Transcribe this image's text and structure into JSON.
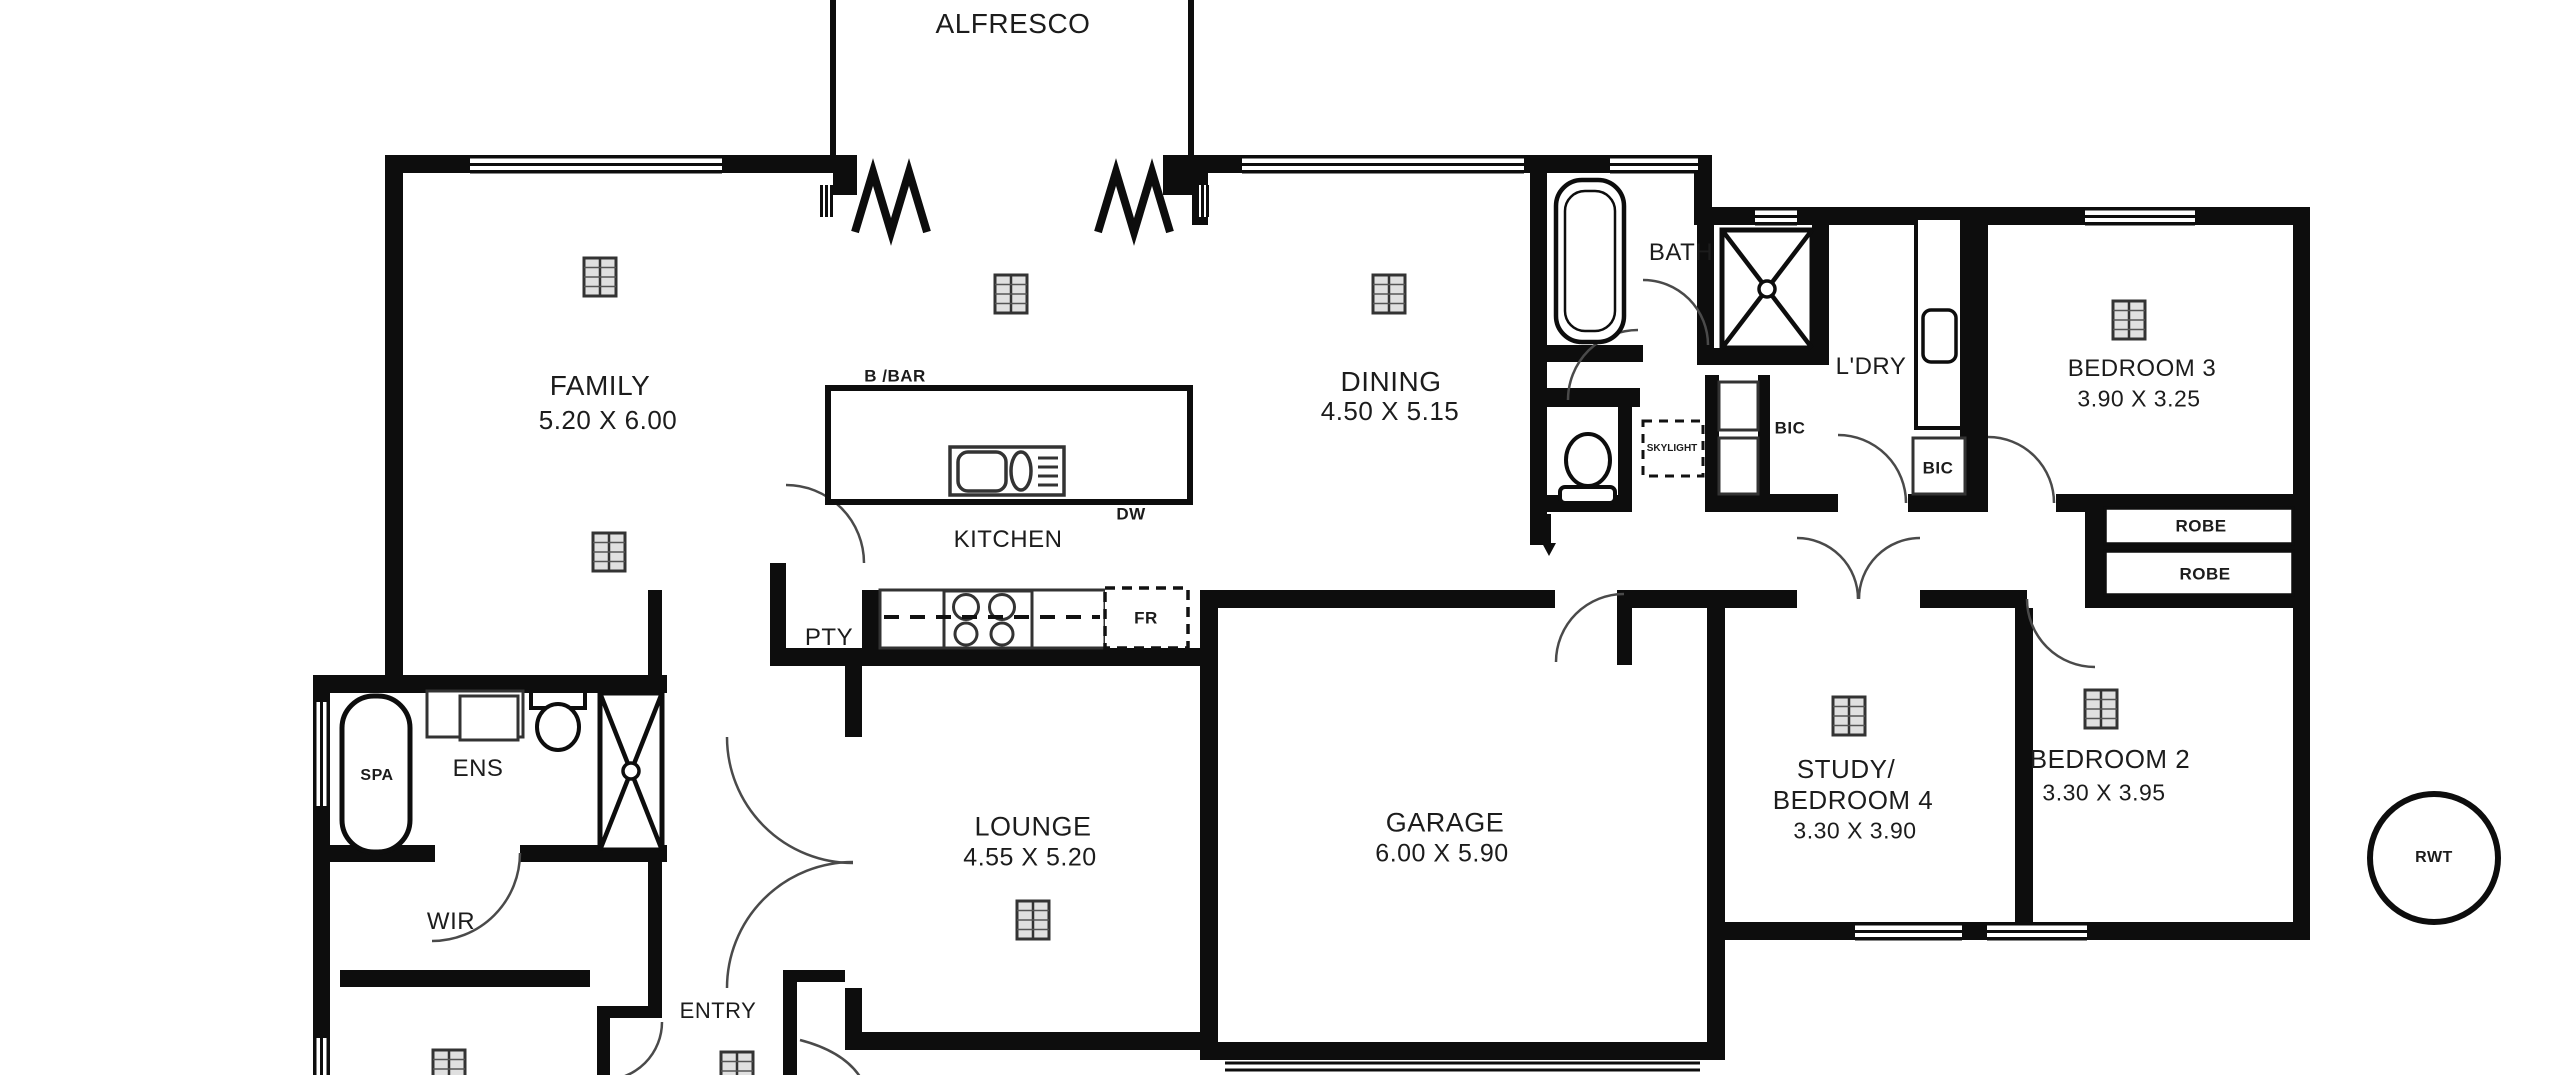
{
  "floorplan": {
    "title": "ALFRESCO",
    "colors": {
      "wall": "#0d0d0d",
      "text": "#1c1c1c",
      "background": "#ffffff",
      "door_arc": "#4a4a4a"
    },
    "rooms": {
      "alfresco": {
        "label": "ALFRESCO"
      },
      "family": {
        "label": "FAMILY",
        "dims": "5.20 X 6.00"
      },
      "kitchen": {
        "label": "KITCHEN"
      },
      "bbar": {
        "label": "B /BAR"
      },
      "dining": {
        "label": "DINING",
        "dims": "4.50 X 5.15"
      },
      "lounge": {
        "label": "LOUNGE",
        "dims": "4.55 X 5.20"
      },
      "garage": {
        "label": "GARAGE",
        "dims": "6.00 X 5.90"
      },
      "study": {
        "label": "STUDY/",
        "label2": "BEDROOM 4",
        "dims": "3.30 X 3.90"
      },
      "bedroom2": {
        "label": "BEDROOM 2",
        "dims": "3.30 X 3.95"
      },
      "bedroom3": {
        "label": "BEDROOM 3",
        "dims": "3.90 X 3.25"
      },
      "bath": {
        "label": "BATH"
      },
      "laundry": {
        "label": "L'DRY"
      },
      "ensuite": {
        "label": "ENS"
      },
      "wir": {
        "label": "WIR"
      },
      "entry": {
        "label": "ENTRY"
      },
      "pantry": {
        "label": "PTY"
      }
    },
    "fixtures": {
      "spa": {
        "label": "SPA"
      },
      "dishwasher": {
        "label": "DW"
      },
      "fridge": {
        "label": "FR"
      },
      "skylight": {
        "label": "SKYLIGHT"
      },
      "bic_linen": {
        "label": "BIC"
      },
      "bic_hall": {
        "label": "BIC"
      },
      "robe_bed3": {
        "label": "ROBE"
      },
      "robe_bed2": {
        "label": "ROBE"
      },
      "rainwater_tank": {
        "label": "RWT"
      }
    }
  }
}
